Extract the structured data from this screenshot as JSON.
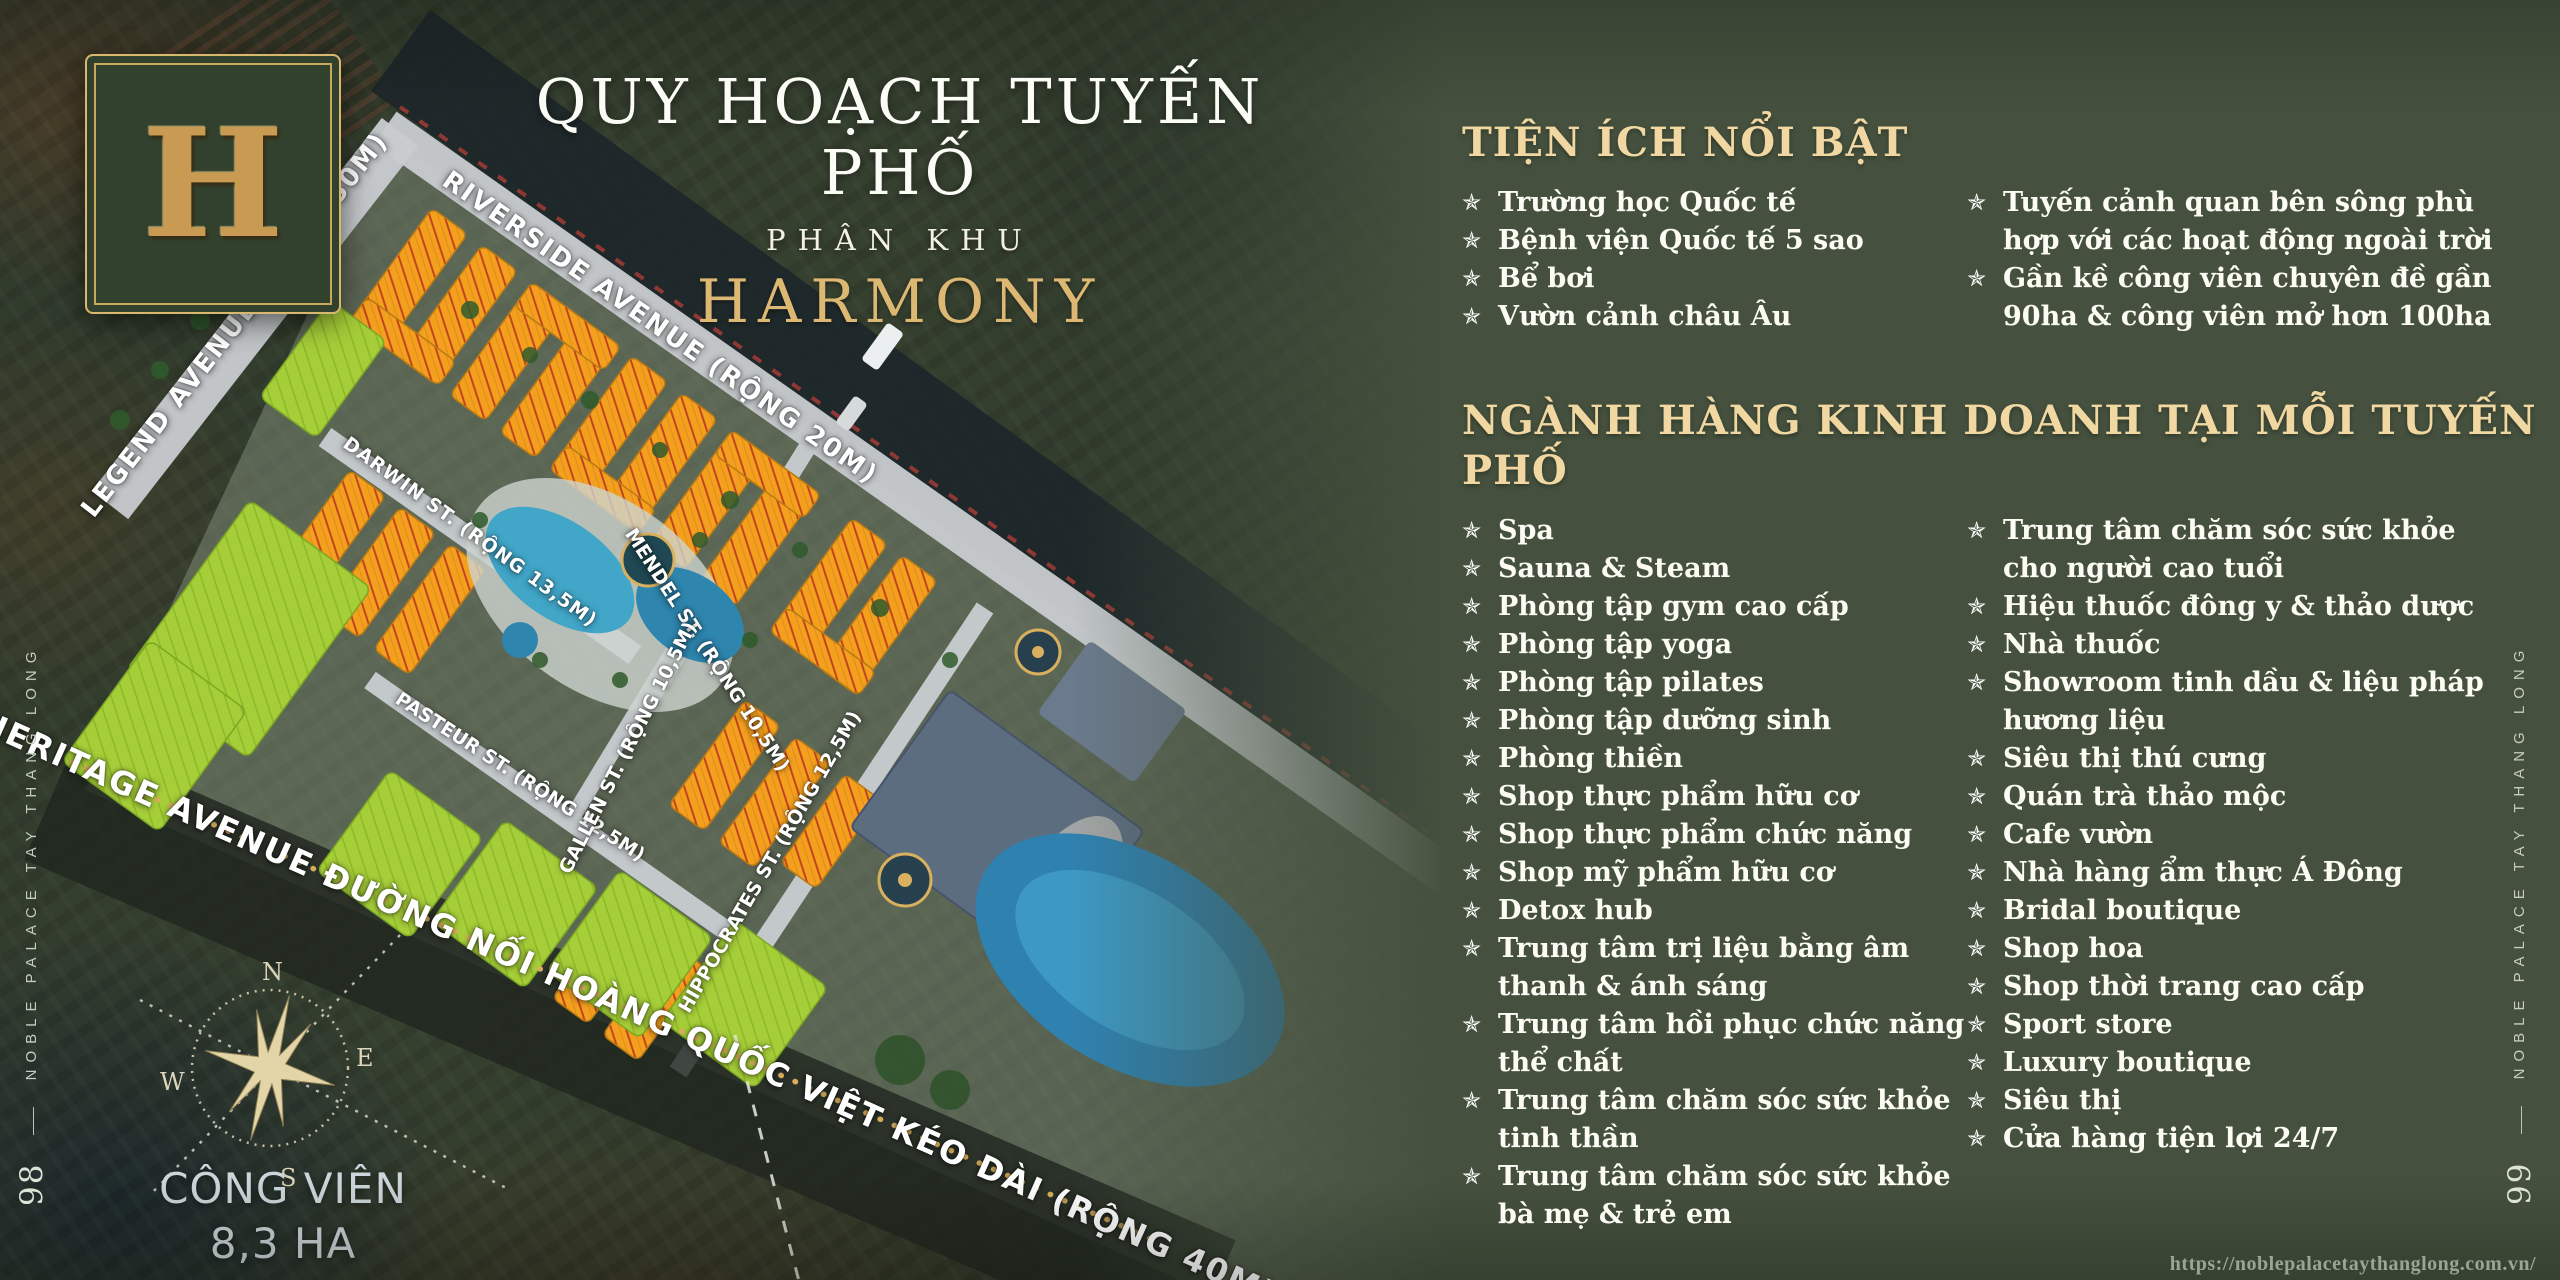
{
  "title": {
    "line1": "QUY HOẠCH TUYẾN PHỐ",
    "line2": "PHÂN KHU",
    "line3": "HARMONY"
  },
  "logo": {
    "letter": "H"
  },
  "amenities": {
    "heading": "TIỆN ÍCH NỔI BẬT",
    "items_col1": [
      "Trường học Quốc tế",
      "Bệnh viện Quốc tế 5 sao",
      "Bể bơi",
      "Vườn cảnh châu Âu"
    ],
    "items_col2": [
      "Tuyến cảnh quan bên sông phù\nhợp với các hoạt động ngoài trời",
      "Gần kề công viên chuyên đề gần\n90ha & công viên mở hơn 100ha"
    ]
  },
  "business": {
    "heading": "NGÀNH HÀNG KINH DOANH TẠI MỖI TUYẾN PHỐ",
    "items_col1": [
      "Spa",
      "Sauna & Steam",
      "Phòng tập gym cao cấp",
      "Phòng tập yoga",
      "Phòng tập pilates",
      "Phòng tập dưỡng sinh",
      "Phòng thiền",
      "Shop thực phẩm hữu cơ",
      "Shop thực phẩm chức năng",
      "Shop mỹ phẩm hữu cơ",
      "Detox hub",
      "Trung tâm trị liệu bằng âm\nthanh & ánh sáng",
      "Trung tâm hồi phục chức năng\nthể chất",
      "Trung tâm chăm sóc sức khỏe\ntinh thần",
      "Trung tâm chăm sóc sức khỏe\nbà mẹ & trẻ em"
    ],
    "items_col2": [
      "Trung tâm chăm sóc sức khỏe\ncho người cao tuổi",
      "Hiệu thuốc đông y & thảo dược",
      "Nhà thuốc",
      "Showroom tinh dầu & liệu pháp\nhương liệu",
      "Siêu thị thú cưng",
      "Quán trà thảo mộc",
      "Cafe vườn",
      "Nhà hàng ẩm thực Á Đông",
      "Bridal boutique",
      "Shop hoa",
      "Shop thời trang cao cấp",
      "Sport store",
      "Luxury boutique",
      "Siêu thị",
      "Cửa hàng tiện lợi 24/7"
    ]
  },
  "map": {
    "streets": {
      "legend": "LEGEND AVENUE (RỘNG 50M)",
      "riverside": "RIVERSIDE AVENUE (RỘNG 20M)",
      "darwin": "DARWIN ST. (RỘNG 13,5M)",
      "mendel": "MENDEL ST. (RỘNG 10,5M)",
      "pasteur": "PASTEUR ST. (RỘNG 12,5M)",
      "gallen": "GALLEN ST. (RỘNG 10,5M)",
      "hippocrates": "HIPPOCRATES ST. (RỘNG 12,5M)",
      "heritage": "HERITAGE AVENUE ĐƯỜNG NỐI HOÀNG QUỐC VIỆT KÉO DÀI (RỘNG 40M)"
    },
    "park": {
      "line1": "CÔNG VIÊN",
      "line2": "8,3 HA"
    },
    "compass": {
      "n": "N",
      "e": "E",
      "s": "S",
      "w": "W"
    }
  },
  "rails": {
    "text": "NOBLE PALACE TAY THANG LONG",
    "left_page_number": "98",
    "right_page_number": "99"
  },
  "footer": {
    "url": "https://noblepalacetaythanglong.com.vn/"
  },
  "icons": {
    "bullet": "✯",
    "dash": "——"
  },
  "colors": {
    "gold_heading": "#F1D8A2",
    "harmony_gold": "#DCB873",
    "panel_green": "#45513E",
    "block_orange": "#F2A01E",
    "block_green": "#A6CE39",
    "pool_blue": "#3F9CC7",
    "boundary_gold": "#D9AE5C"
  }
}
